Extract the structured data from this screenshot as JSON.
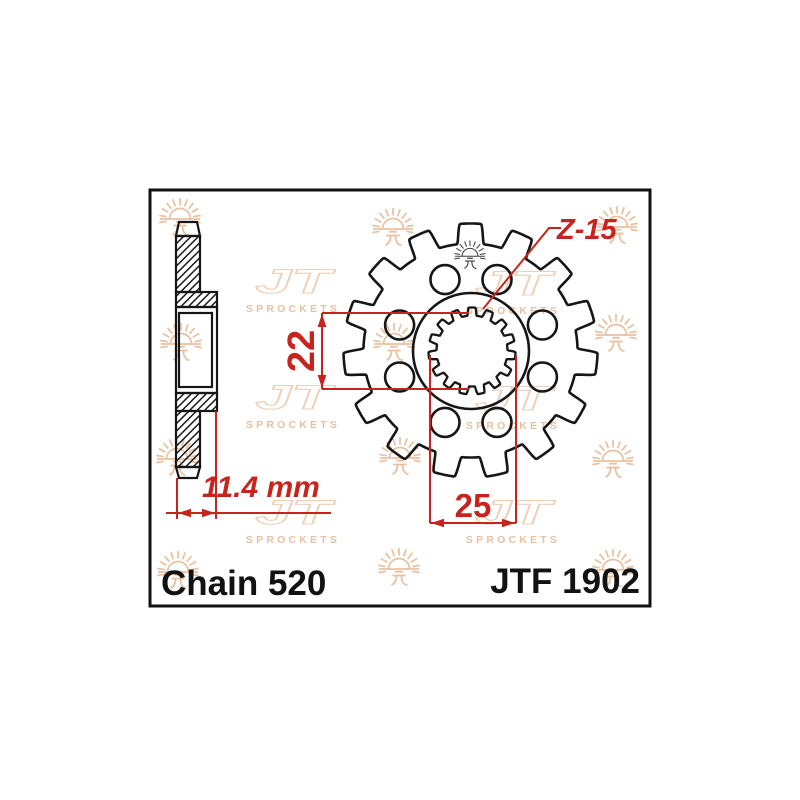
{
  "page": {
    "background": "#ffffff"
  },
  "drawing": {
    "part_number": "JTF 1902",
    "chain_label": "Chain 520",
    "teeth_count": 15,
    "annotations": {
      "teeth_label": "Z-15",
      "spline_height": "22",
      "spline_width": "25",
      "hub_width": "11.4 mm"
    }
  },
  "watermark": {
    "monogram": "JT",
    "brand": "SPROCKETS"
  },
  "colors": {
    "line": "#161616",
    "border": "#111111",
    "dimension_red": "#c8241e",
    "watermark_peach": "#e9c0a0",
    "watermark_light": "#eed0b8",
    "dark_mark": "#3f3f3f"
  }
}
